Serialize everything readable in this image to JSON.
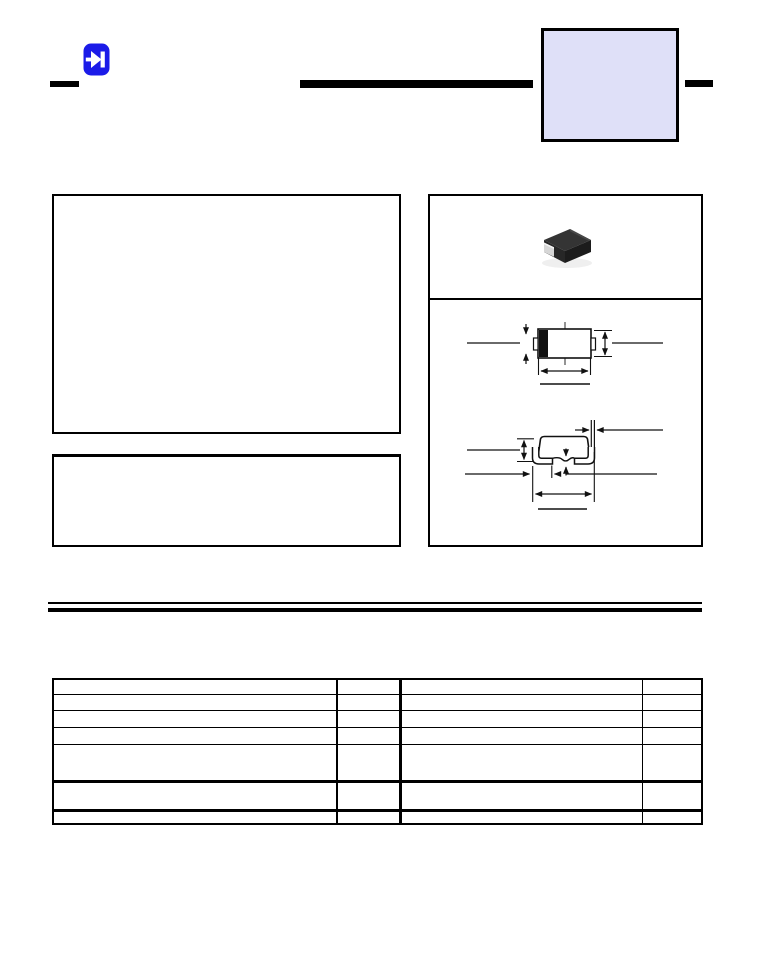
{
  "page": {
    "background_color": "#ffffff"
  },
  "header": {
    "logo": {
      "icon": "diode-icon",
      "fill_color": "#1b1be8",
      "symbol_color": "#ffffff"
    },
    "left_tick_color": "#000000",
    "title_rule_color": "#000000",
    "part_number_box": {
      "fill_color": "#dfe0f8",
      "border_color": "#000000",
      "text": ""
    },
    "right_tick_color": "#000000"
  },
  "left_column": {
    "features_box_text": "",
    "notes_box_text": ""
  },
  "package_panel": {
    "photo": {
      "label": "smd-package-photo",
      "body_color": "#2a2a2a",
      "terminal_color": "#d6d6d6"
    },
    "top_view_drawing": {
      "label": "package-top-view",
      "cathode_band_color": "#111111"
    },
    "side_view_drawing": {
      "label": "package-side-view"
    }
  },
  "separator": {
    "style": "thin-over-thick-double-rule",
    "color": "#000000"
  },
  "table": {
    "row_count": 7,
    "column_count": 4,
    "cells": [
      [
        "",
        "",
        "",
        ""
      ],
      [
        "",
        "",
        "",
        ""
      ],
      [
        "",
        "",
        "",
        ""
      ],
      [
        "",
        "",
        "",
        ""
      ],
      [
        "",
        "",
        "",
        ""
      ],
      [
        "",
        "",
        "",
        ""
      ],
      [
        "",
        "",
        "",
        ""
      ]
    ]
  }
}
